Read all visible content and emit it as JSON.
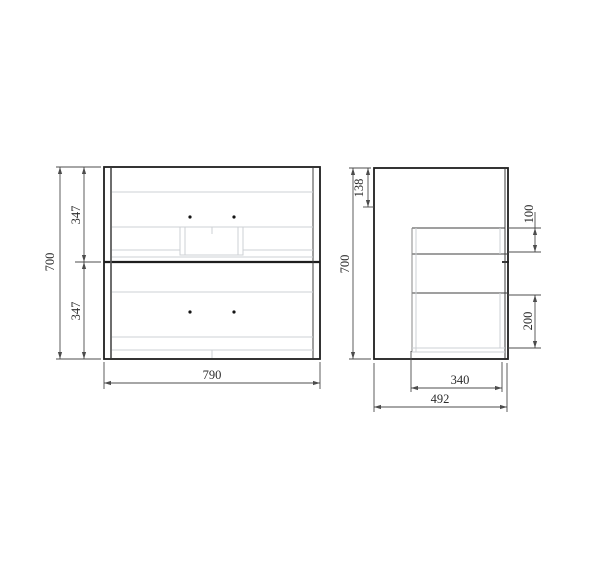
{
  "front_view": {
    "total_height": "700",
    "upper_drawer_height": "347",
    "lower_drawer_height": "347",
    "total_width": "790"
  },
  "side_view": {
    "total_height": "700",
    "top_offset": "138",
    "upper_drawer_box_height": "100",
    "lower_drawer_box_height": "200",
    "drawer_depth": "340",
    "total_depth": "492"
  },
  "colors": {
    "outline": "#1e1e1e",
    "inner_line": "#3f3f3f",
    "panel_line": "#555555",
    "mid_line": "#8a8a8a",
    "light_line": "#cdd1d4",
    "dimension": "#4c4c4c",
    "text": "#2b2b2b",
    "dot": "#141414",
    "background": "#ffffff"
  }
}
